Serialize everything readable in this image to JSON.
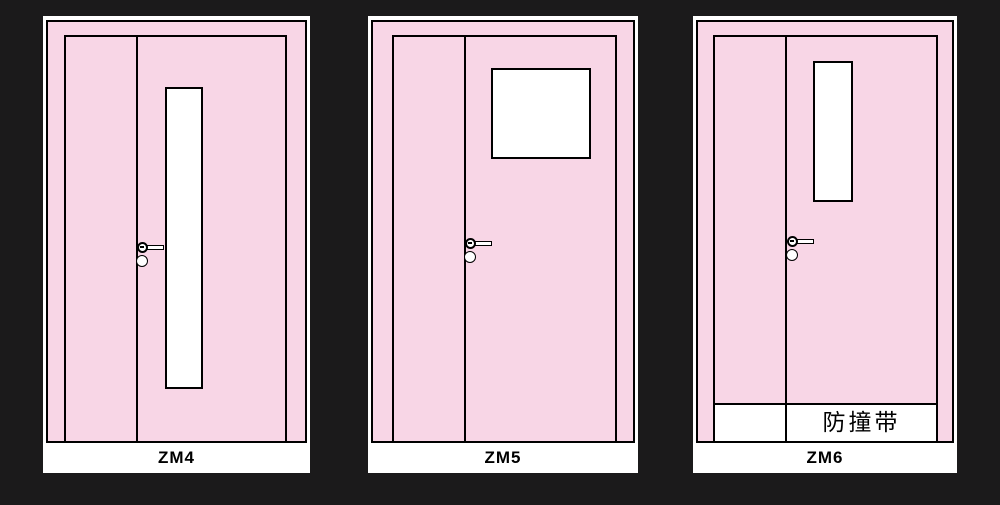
{
  "canvas": {
    "background_color": "#1b1a1b"
  },
  "colors": {
    "door_fill": "#f8d6e6",
    "outline": "#000000",
    "frame_white": "#ffffff",
    "glass_white": "#ffffff",
    "label_text": "#000000"
  },
  "doors": [
    {
      "label": "ZM4",
      "vision_panel": "tall narrow vertical window",
      "hardware": "lever handle with lock cylinder"
    },
    {
      "label": "ZM5",
      "vision_panel": "square window at top",
      "hardware": "lever handle with lock cylinder"
    },
    {
      "label": "ZM6",
      "vision_panel": "short vertical window at top",
      "hardware": "lever handle with lock cylinder",
      "band_label": "防撞带"
    }
  ]
}
